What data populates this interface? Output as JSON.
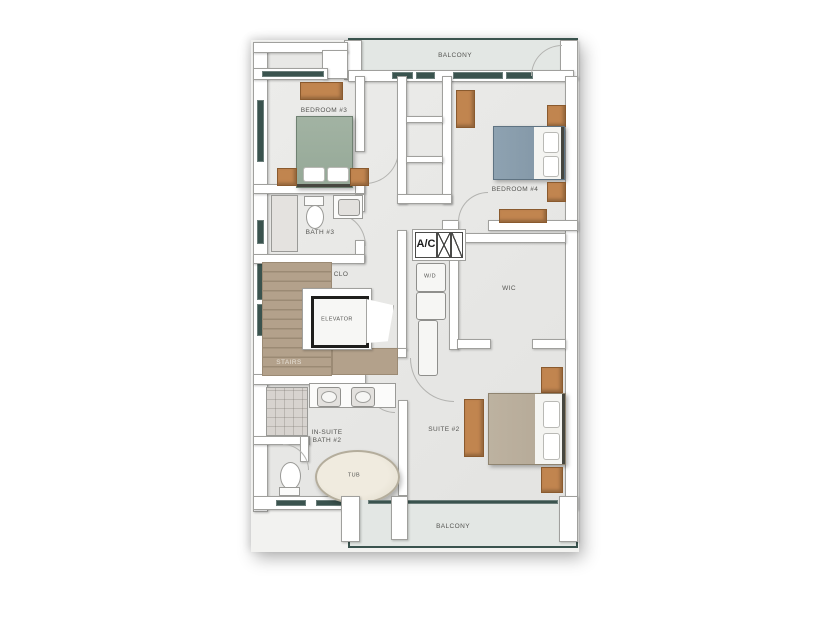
{
  "plan": {
    "name": "third-floor-plan",
    "labels": {
      "balcony_top": "BALCONY",
      "balcony_bottom": "BALCONY",
      "bedroom3": "BEDROOM #3",
      "bath3": "BATH #3",
      "clo": "CLO",
      "stairs": "STAIRS",
      "elevator": "ELEVATOR",
      "wd": "W/D",
      "ac": "A/C",
      "wic": "WIC",
      "bedroom4": "BEDROOM #4",
      "suite2": "SUITE #2",
      "insuite_bath2": "IN-SUITE BATH #2",
      "tub": "TUB"
    },
    "colors": {
      "floor": "#e8e8e6",
      "balcony_floor": "#e3e7e4",
      "wall": "#ffffff",
      "wall_outline": "#a0a09d",
      "window_glass": "#3a534e",
      "wood": "#c1854f",
      "stairs_wood": "#b3a18b",
      "bed3": "#95a897",
      "bed4": "#7f93a3",
      "suite_bed": "#b3a795",
      "label_text": "#555552"
    }
  }
}
